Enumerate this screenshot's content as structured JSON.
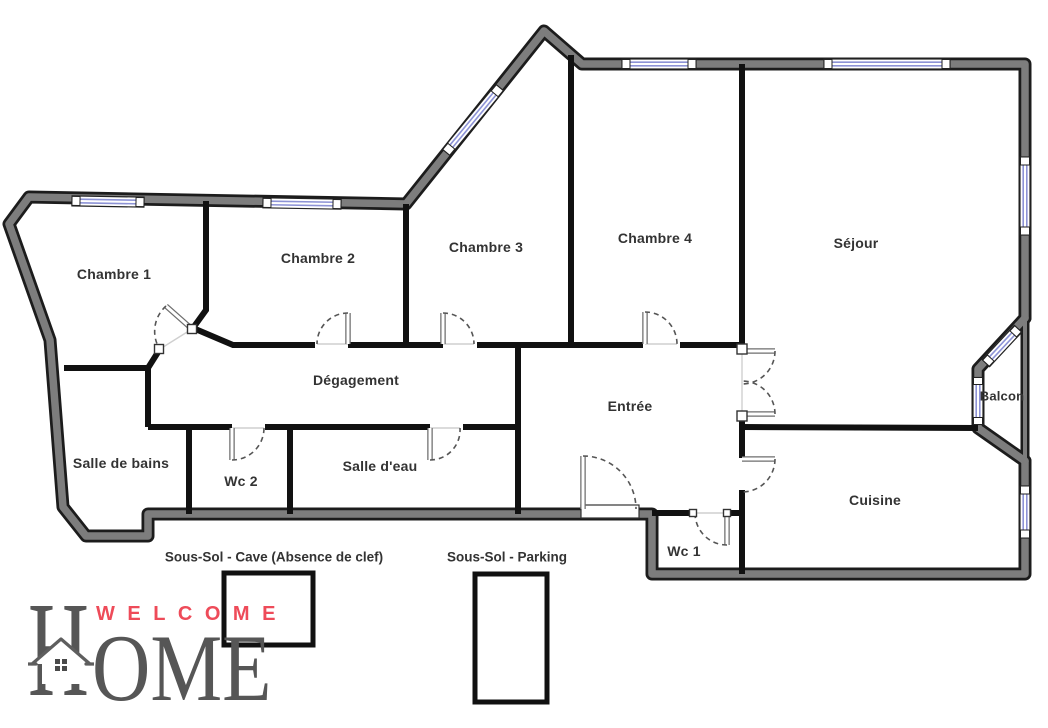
{
  "floorplan": {
    "rooms": [
      {
        "name": "chambre-1",
        "label": "Chambre 1"
      },
      {
        "name": "chambre-2",
        "label": "Chambre 2"
      },
      {
        "name": "chambre-3",
        "label": "Chambre 3"
      },
      {
        "name": "chambre-4",
        "label": "Chambre 4"
      },
      {
        "name": "sejour",
        "label": "Séjour"
      },
      {
        "name": "degagement",
        "label": "Dégagement"
      },
      {
        "name": "entree",
        "label": "Entrée"
      },
      {
        "name": "salle-de-bains",
        "label": "Salle de bains"
      },
      {
        "name": "wc-2",
        "label": "Wc 2"
      },
      {
        "name": "salle-d-eau",
        "label": "Salle d'eau"
      },
      {
        "name": "wc-1",
        "label": "Wc 1"
      },
      {
        "name": "cuisine",
        "label": "Cuisine"
      },
      {
        "name": "balcon",
        "label": "Balcon"
      }
    ],
    "basement": [
      {
        "name": "cave",
        "label": "Sous-Sol - Cave (Absence de clef)"
      },
      {
        "name": "parking",
        "label": "Sous-Sol - Parking"
      }
    ]
  },
  "logo": {
    "welcome": "WELCOME",
    "h": "H",
    "ome": "OME"
  },
  "colors": {
    "wall_gray": "#7d7d7d",
    "wall_dark": "#1c1c1c",
    "window_blue": "#8d93d6",
    "logo_red": "#ee4b59",
    "logo_gray": "#565656",
    "label_color": "#333333"
  }
}
